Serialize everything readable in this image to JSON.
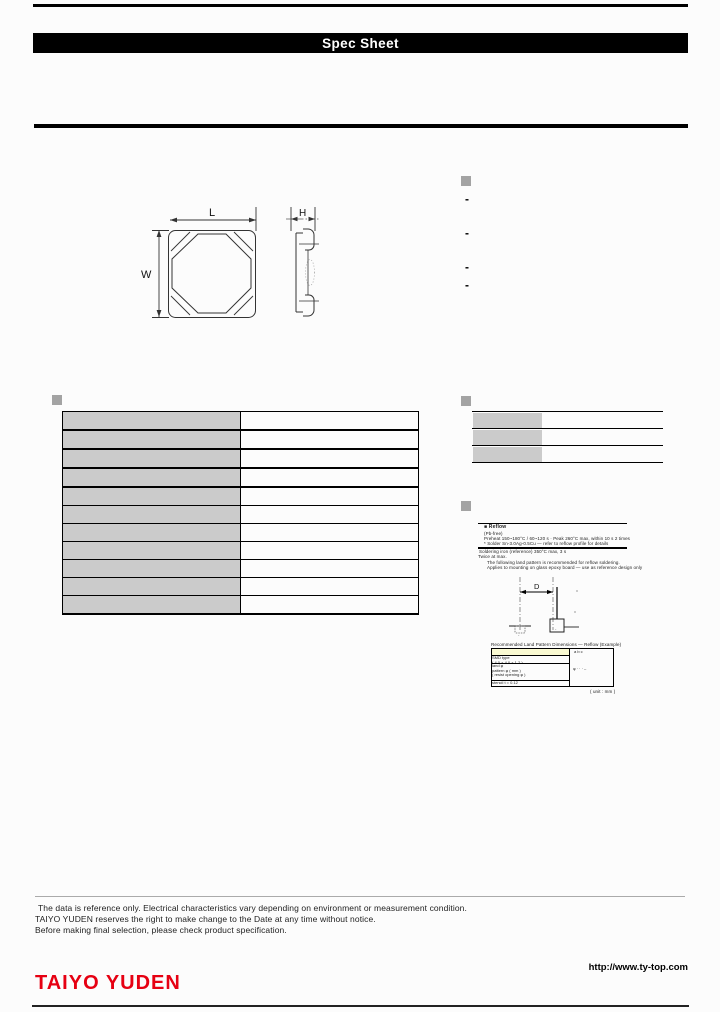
{
  "header": {
    "title": "Spec Sheet"
  },
  "drawing": {
    "length_label": "L",
    "width_label": "W",
    "height_label": "H"
  },
  "features": {
    "items": [
      "-",
      "-",
      "-",
      "-"
    ]
  },
  "notes": {
    "box_header": "■  Reflow",
    "box_line1": "(Pb-free)",
    "box_line2": "Preheat 150~180°C / 60~120 s · Peak 260°C max, within 10 s  2 times",
    "box_line3": "* Solder Sn-3.0Ag-0.5Cu — refer to reflow profile for details",
    "sub_line1": "Soldering iron (reference) 350°C max, 3 s",
    "sub_line2": "Twice at max.",
    "sub_line3": "The following land pattern is recommended for reflow soldering.",
    "sub_line4": "Applies to mounting on glass epoxy board — use as reference design only"
  },
  "land_pattern": {
    "d_label": "D",
    "pad_mark_left": "-",
    "pad_mark_right": "-",
    "table_title": "Recommended Land Pattern Dimensions — Reflow (Example)",
    "col_marks": "a      b      c",
    "row1": "b",
    "row2a": "SMD type",
    "row2b": "( 4.0 × 4.0 × 1.2 )",
    "row3a": "land φ",
    "row3b": "pattern φ ( mm )",
    "row3c": "( resist opening φ )",
    "row4": "stencil  t = 0.12",
    "value_marks": "φ    · ·    · –",
    "unit_note": "( unit : mm )"
  },
  "disclaimer": {
    "line1": "The data is reference only. Electrical characteristics vary depending on environment or measurement condition.",
    "line2": "TAIYO YUDEN reserves the right to make change to the Date at any time without notice.",
    "line3": "Before making final selection, please check product specification."
  },
  "footer": {
    "logo": "TAIYO YUDEN",
    "url": "http://www.ty-top.com"
  }
}
